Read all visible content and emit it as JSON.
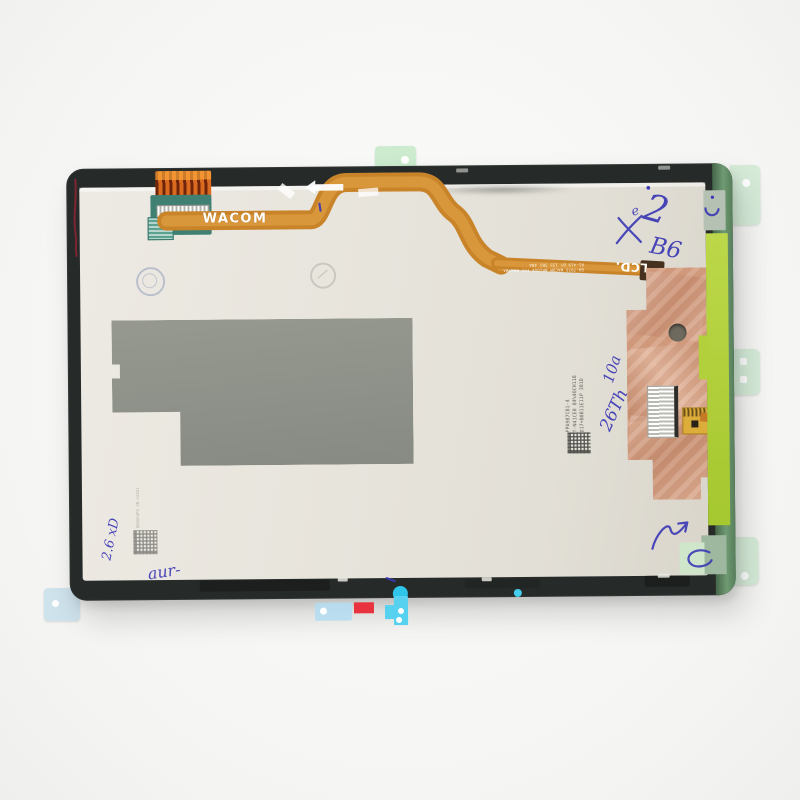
{
  "scene": {
    "type": "product photo",
    "subject": "Rear view of a tablet LCD display assembly replacement part with Wacom digitizer flex cable",
    "background_color": "#f6f6f4"
  },
  "device": {
    "frame_color": "#262a29",
    "frame_right_edge_color": "#5c815f",
    "back_panel_color": "#e7e4dc",
    "graphite_pad_color": "#90938d",
    "copper_foil_color": "#d6a083",
    "lime_tape_color": "#b2d03c",
    "pale_green_tab_color": "#d6ecd9",
    "flex_cable_color": "#c9842a"
  },
  "printed_labels": {
    "wacom_ribbon": "WACOM",
    "lcd_flex": "LCD.",
    "flex_microtext_line1": "GH-7975 WACOM BRIDGE FPC R04 #A",
    "flex_microtext_line2": "01-419 BY 135 3B1 4BA",
    "panel_serial_lines": [
      "FPA987CB1-4",
      "T-N41CE0 84%4OCH118",
      "D17+B0B11E11P 381D"
    ],
    "left_serial_line": "DB0UK4P5 VN-CA3O1"
  },
  "handwritten_marks": {
    "ink_color": "#3a37b5",
    "top_small": "e",
    "top_big": "2",
    "code_b6": "B6",
    "mid_line1": "10a",
    "mid_line2": "26Th",
    "left_rotated": "2.6 xD",
    "bottom_left": "aur-"
  },
  "adhesive_pieces": {
    "red_tape_color": "#e8333f",
    "cyan_tape_color": "#3cc9ee",
    "light_blue_tape_color": "#b4ddf0"
  }
}
